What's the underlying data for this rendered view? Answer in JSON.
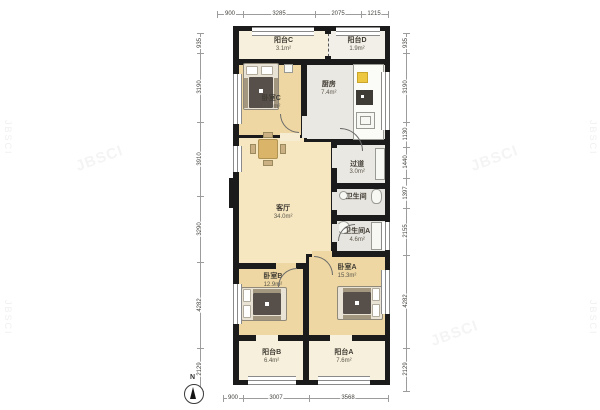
{
  "rooms": {
    "balcony_c": {
      "name": "阳台C",
      "area": "3.1m²"
    },
    "balcony_d": {
      "name": "阳台D",
      "area": "1.9m²"
    },
    "bedroom_c": {
      "name": "卧室C",
      "area": "11.7m²"
    },
    "kitchen": {
      "name": "厨房",
      "area": "7.4m²"
    },
    "living": {
      "name": "客厅",
      "area": "34.0m²"
    },
    "hallway": {
      "name": "过道",
      "area": "3.0m²"
    },
    "bathroom": {
      "name": "卫生间",
      "area": ""
    },
    "bathroom_a": {
      "name": "卫生间A",
      "area": "4.6m²"
    },
    "bedroom_b": {
      "name": "卧室B",
      "area": "12.9m²"
    },
    "bedroom_a": {
      "name": "卧室A",
      "area": "15.3m²"
    },
    "balcony_b": {
      "name": "阳台B",
      "area": "6.4m²"
    },
    "balcony_a": {
      "name": "阳台A",
      "area": "7.6m²"
    }
  },
  "dimensions": {
    "top": [
      "900",
      "3285",
      "2075",
      "1215"
    ],
    "bottom": [
      "900",
      "3007",
      "3568"
    ],
    "left": [
      "935",
      "3190",
      "3910",
      "3290",
      "4282",
      "2129"
    ],
    "right": [
      "935",
      "3190",
      "1130",
      "1440",
      "1397",
      "2155",
      "4282",
      "2129"
    ]
  },
  "compass": {
    "north_label": "N"
  },
  "watermark": {
    "text": "JBSCI"
  },
  "colors": {
    "wall": "#1b1b1b",
    "bedroom_fill": "#eed7a2",
    "living_fill": "#f6e7c0",
    "service_fill": "#eae8e2",
    "balcony_fill": "#f7f0dc",
    "accent_yellow": "#edc73f",
    "blanket": "#57504a"
  }
}
